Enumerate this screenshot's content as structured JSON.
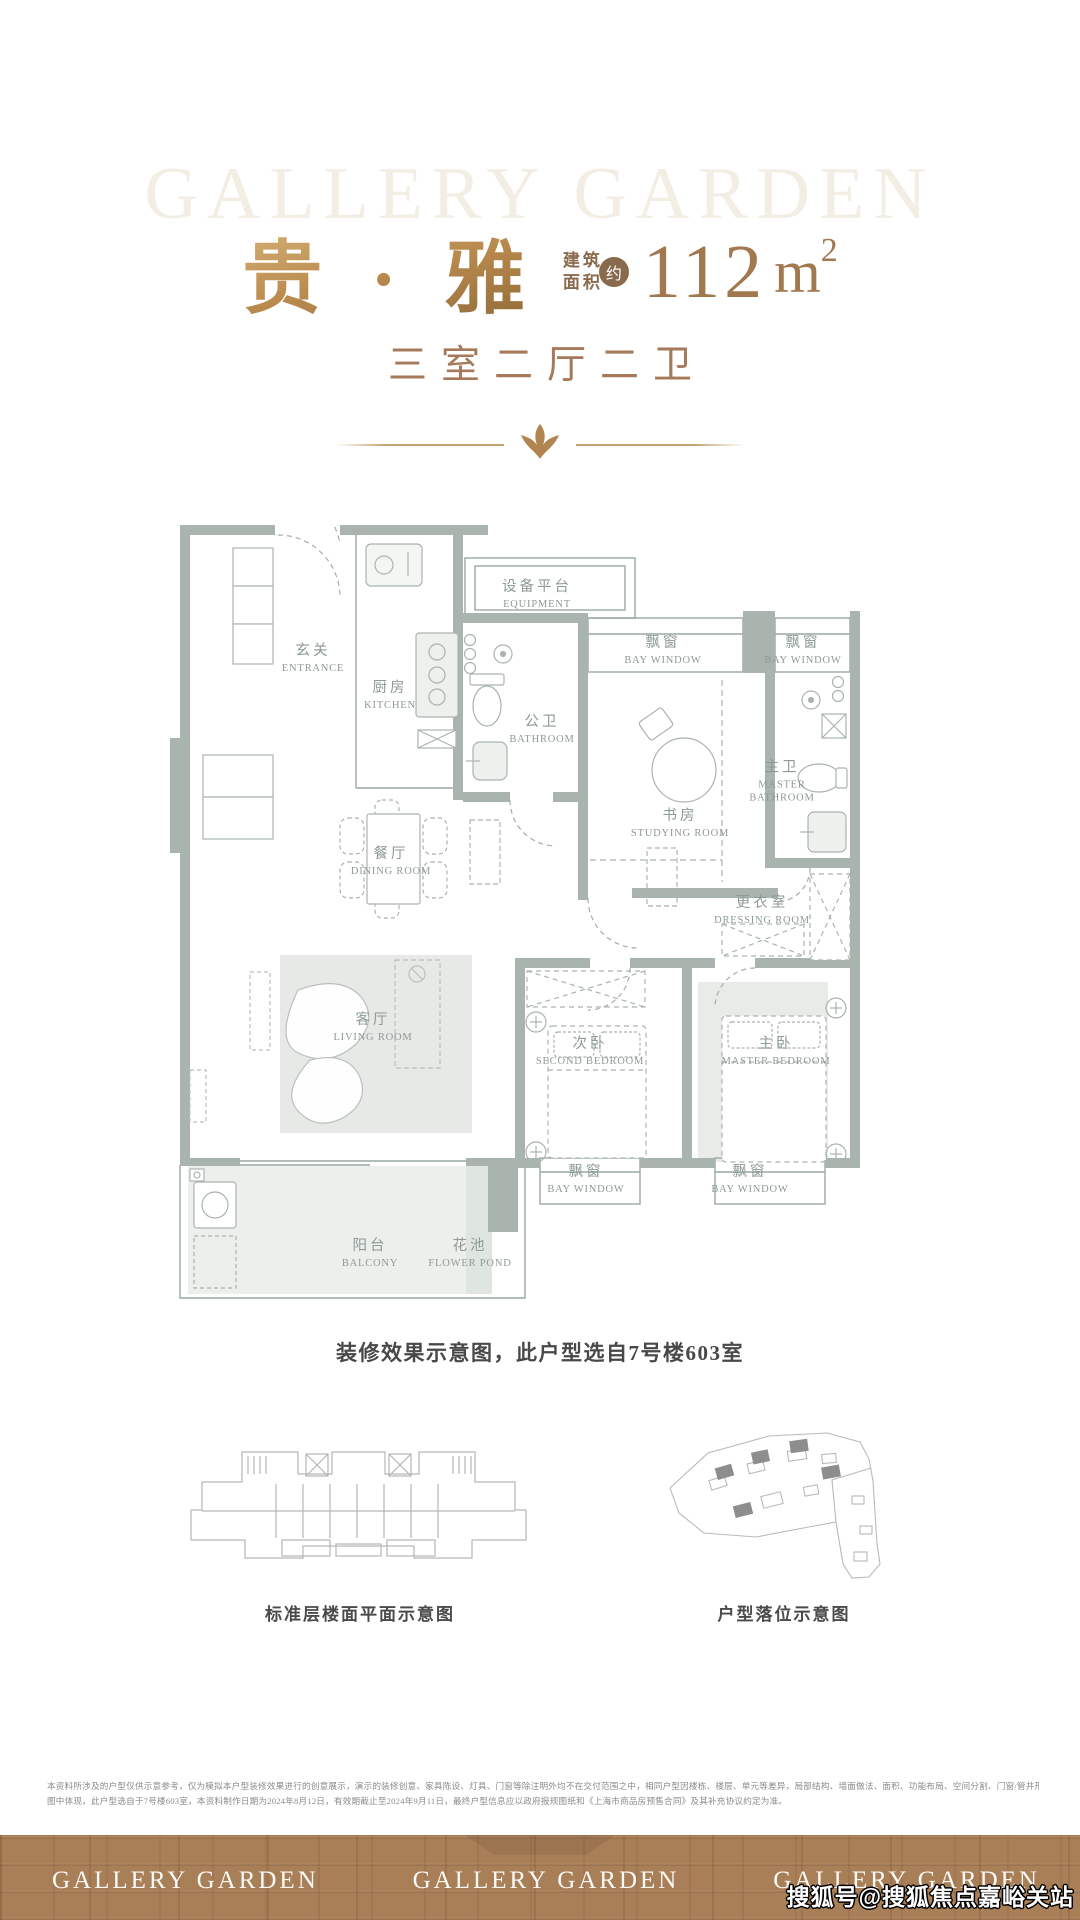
{
  "header": {
    "brand_watermark": "GALLERY GARDEN",
    "unit_name": "贵 · 雅",
    "area_label_line1": "建筑",
    "area_label_line2": "面积",
    "area_approx_badge": "约",
    "area_value": "112",
    "area_unit": "m",
    "area_exponent": "2",
    "subtitle": "三室二厅二卫"
  },
  "floor_plan": {
    "caption": "装修效果示意图，此户型选自7号楼603室",
    "rooms": [
      {
        "cn": "玄关",
        "en": "ENTRANCE",
        "x": 143,
        "y": 227
      },
      {
        "cn": "厨房",
        "en": "KITCHEN",
        "x": 220,
        "y": 264
      },
      {
        "cn": "设备平台",
        "en": "EQUIPMENT",
        "x": 367,
        "y": 163
      },
      {
        "cn": "飘窗",
        "en": "BAY WINDOW",
        "x": 493,
        "y": 219
      },
      {
        "cn": "飘窗",
        "en": "BAY WINDOW",
        "x": 633,
        "y": 219
      },
      {
        "cn": "公卫",
        "en": "BATHROOM",
        "x": 372,
        "y": 298
      },
      {
        "cn": "主卫",
        "en": "MASTER BATHROOM",
        "x": 612,
        "y": 350,
        "w": 82
      },
      {
        "cn": "书房",
        "en": "STUDYING ROOM",
        "x": 510,
        "y": 392
      },
      {
        "cn": "更衣室",
        "en": "DRESSING ROOM",
        "x": 592,
        "y": 479
      },
      {
        "cn": "餐厅",
        "en": "DINING ROOM",
        "x": 221,
        "y": 430
      },
      {
        "cn": "客厅",
        "en": "LIVING ROOM",
        "x": 203,
        "y": 596
      },
      {
        "cn": "次卧",
        "en": "SECOND BEDROOM",
        "x": 420,
        "y": 620
      },
      {
        "cn": "主卧",
        "en": "MASTER BEDROOM",
        "x": 606,
        "y": 620
      },
      {
        "cn": "飘窗",
        "en": "BAY WINDOW",
        "x": 416,
        "y": 748
      },
      {
        "cn": "飘窗",
        "en": "BAY WINDOW",
        "x": 580,
        "y": 748
      },
      {
        "cn": "阳台",
        "en": "BALCONY",
        "x": 200,
        "y": 822
      },
      {
        "cn": "花池",
        "en": "FLOWER POND",
        "x": 300,
        "y": 822
      }
    ]
  },
  "diagrams": {
    "left_caption": "标准层楼面平面示意图",
    "right_caption": "户型落位示意图"
  },
  "disclaimer": {
    "line1": "本资料所涉及的户型仅供示意参考，仅为模拟本户型装修效果进行的创意展示，演示的装修创意、家具陈设、灯具、门窗等除注明外均不在交付范围之中，相同户型因楼栋、楼层、单元等差异，局部结构、墙面做法、面积、功能布局、空间分割、门窗/管井形态位置等可能有不同，且强弱电箱、插座位置等均未在户型",
    "line2": "图中体现，此户型选自于7号楼603室，本资料制作日期为2024年8月12日，有效期截止至2024年9月11日，最终户型信息应以政府报规图纸和《上海市商品房预售合同》及其补充协议约定为准。"
  },
  "footer": {
    "logos": [
      "GALLERY GARDEN",
      "GALLERY GARDEN",
      "GALLERY GARDEN"
    ]
  },
  "watermark": {
    "text": "搜狐号@搜狐焦点嘉峪关站"
  },
  "colors": {
    "gold": "#b0854f",
    "title_gold": "#b98a4e",
    "number_brown": "#a2794f",
    "subtitle_brown": "#a5795a",
    "wall_sage": "#a9b4af",
    "label_gray": "#8d9a95",
    "brick_brown": "#a97f58",
    "caption_dark": "#484848"
  }
}
